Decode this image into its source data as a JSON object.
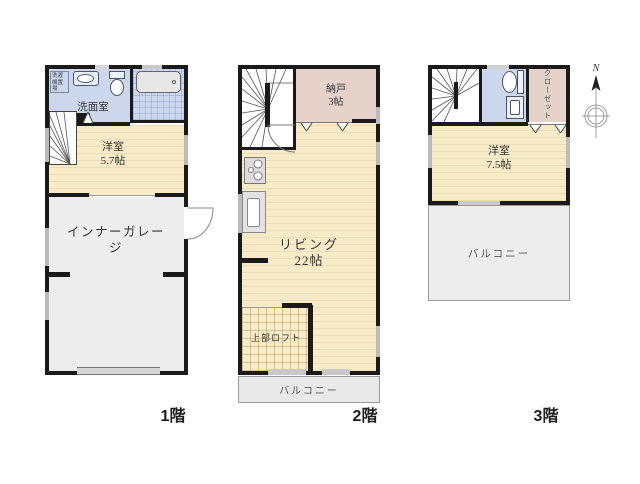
{
  "floors": {
    "floor1": {
      "label": "1階",
      "washroom_label": "洗面室",
      "laundry_label": "洗濯機置場",
      "bedroom_label": "洋室",
      "bedroom_size": "5.7帖",
      "garage_label": "インナーガレージ"
    },
    "floor2": {
      "label": "2階",
      "storage_label": "納戸",
      "storage_size": "3帖",
      "living_label": "リビング",
      "living_size": "22帖",
      "loft_label": "上部ロフト",
      "balcony_label": "バルコニー"
    },
    "floor3": {
      "label": "3階",
      "bedroom_label": "洋室",
      "bedroom_size": "7.5帖",
      "closet_label": "クローゼット",
      "balcony_label": "バルコニー"
    }
  },
  "compass": {
    "north_label": "N"
  },
  "colors": {
    "wall": "#1a1a1a",
    "room_cream": "#f7ebc8",
    "wet_area_blue": "#ccd7ec",
    "storage_pink": "#e4d2cb",
    "garage_gray": "#ededed",
    "balcony_gray": "#e9e9e9"
  }
}
